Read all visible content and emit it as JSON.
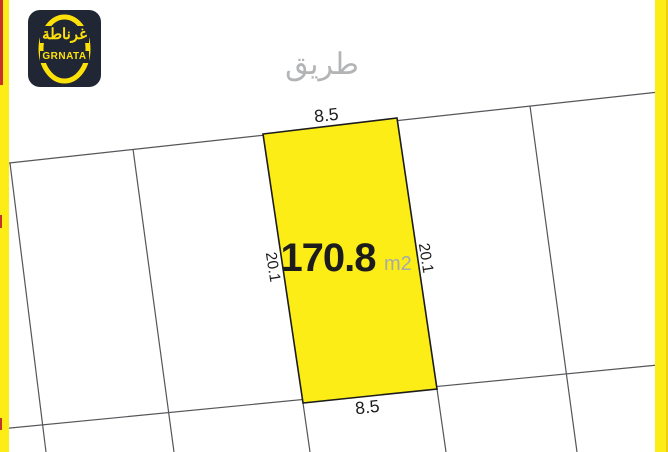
{
  "logo": {
    "arabic": "غرناطة",
    "latin": "GRNATA"
  },
  "road": {
    "label": "طريق"
  },
  "plot": {
    "area": "170.8",
    "area_unit": "m2",
    "top_width": "8.5",
    "bottom_width": "8.5",
    "left_length": "20.1",
    "right_length": "20.1"
  },
  "colors": {
    "highlight_yellow": "#FBED15",
    "edge_strip_yellow": "#FBED15",
    "left_edge_red": "#C5332A",
    "map_line_gray": "#55565a",
    "dimension_text": "#1c1c1c",
    "road_label_gray": "#b2b4b6",
    "area_unit_gray": "#a7a9ac",
    "logo_background": "#202634",
    "logo_yellow": "#FFE10A"
  }
}
